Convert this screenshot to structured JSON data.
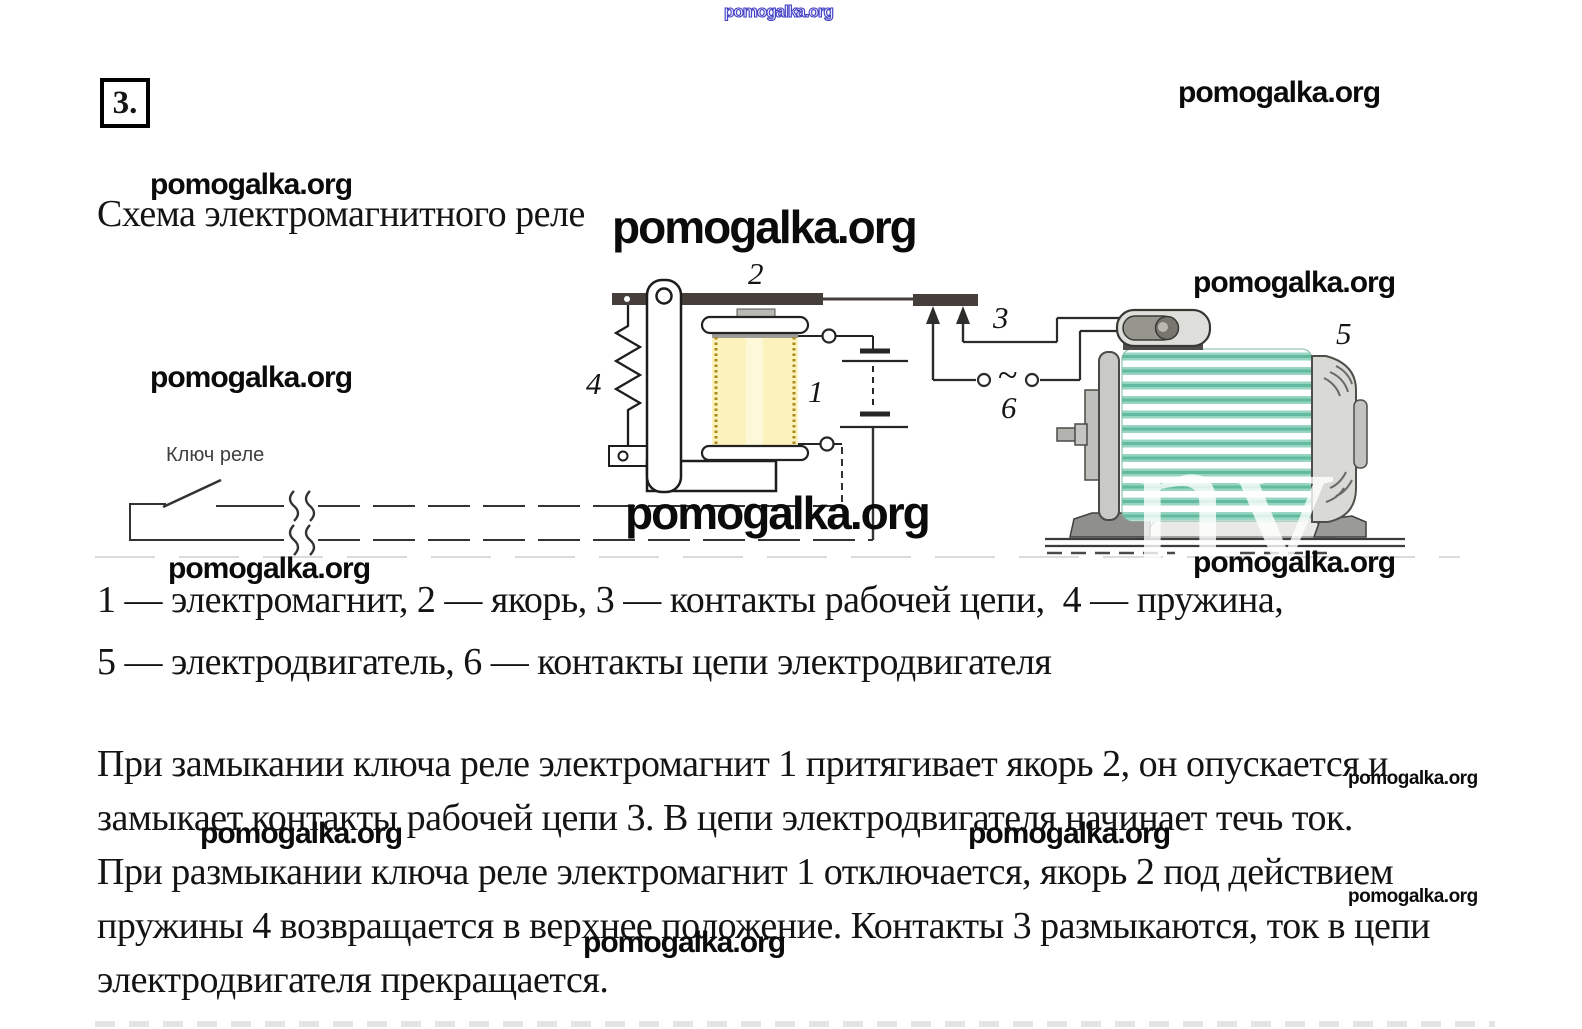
{
  "page": {
    "badge": "3.",
    "heading": "Схема электромагнитного реле"
  },
  "watermark": {
    "text": "pomogalka.org",
    "motor_overlay": "nv"
  },
  "diagram": {
    "key_label": "Ключ реле",
    "ac_symbol": "~",
    "labels": {
      "electromagnet": "1",
      "armature": "2",
      "working_contacts": "3",
      "spring": "4",
      "motor": "5",
      "motor_contacts": "6"
    }
  },
  "caption": {
    "line1": "1 — электромагнит, 2 — якорь, 3 — контакты рабочей цепи,  4 — пружина,",
    "line2": "5 — электродвигатель, 6 — контакты цепи электродвигателя"
  },
  "body": {
    "lines": [
      "При замыкании ключа реле электромагнит 1 притягивает якорь 2, он опускается и",
      "замыкает контакты рабочей цепи 3. В цепи электродвигателя начинает течь ток.",
      "При размыкании ключа реле электромагнит 1 отключается, якорь 2 под действием",
      "пружины 4 возвращается в верхнее положение. Контакты 3 размыкаются, ток в цепи",
      "электродвигателя прекращается."
    ]
  }
}
